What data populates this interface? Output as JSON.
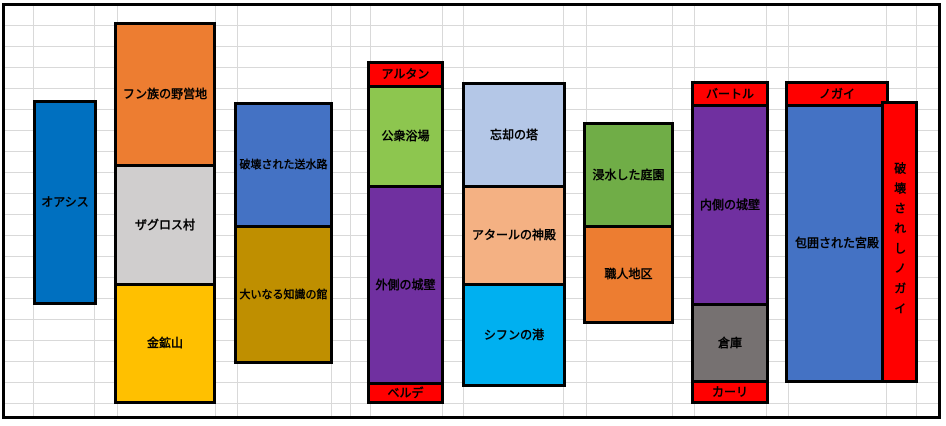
{
  "sheet": {
    "background": "#FFFFFF",
    "gridline_color": "#D9D9D9",
    "outer_border_color": "#000000",
    "label_text_color": "#000000",
    "enemy_header_color": "#FF0000"
  },
  "columns": [
    {
      "name": "oasis",
      "x": 36,
      "y": 103,
      "w": 58,
      "segments": [
        {
          "name": "oasis",
          "label": "オアシス",
          "color": "#0070C0",
          "h": 199
        }
      ]
    },
    {
      "name": "hun-zagros-goldmine",
      "x": 117,
      "y": 25,
      "w": 96,
      "segments": [
        {
          "name": "hun-camp",
          "label": "フン族の野営地",
          "color": "#ED7D31",
          "h": 139
        },
        {
          "name": "zagros-village",
          "label": "ザグロス村",
          "color": "#D0CECE",
          "h": 119
        },
        {
          "name": "gold-mine",
          "label": "金鉱山",
          "color": "#FFC000",
          "h": 118
        }
      ]
    },
    {
      "name": "aqueduct-knowledge",
      "x": 237,
      "y": 105,
      "w": 93,
      "segments": [
        {
          "name": "destroyed-aqueduct",
          "label": "破壊された送水路",
          "color": "#4472C4",
          "h": 120
        },
        {
          "name": "house-of-great-knowledge",
          "label": "大いなる知識の館",
          "color": "#BF8F00",
          "h": 136
        }
      ]
    },
    {
      "name": "altan-stack",
      "x": 370,
      "y": 64,
      "w": 71,
      "segments": [
        {
          "name": "altan",
          "label": "アルタン",
          "color": "#FF0000",
          "h": 21
        },
        {
          "name": "public-baths",
          "label": "公衆浴場",
          "color": "#8DC64F",
          "h": 100
        },
        {
          "name": "outer-wall",
          "label": "外側の城壁",
          "color": "#7030A0",
          "h": 197
        },
        {
          "name": "berde",
          "label": "ベルデ",
          "color": "#FF0000",
          "h": 19
        }
      ]
    },
    {
      "name": "tower-temple-port",
      "x": 465,
      "y": 85,
      "w": 98,
      "segments": [
        {
          "name": "tower-of-oblivion",
          "label": "忘却の塔",
          "color": "#B4C7E7",
          "h": 100
        },
        {
          "name": "temple-of-atar",
          "label": "アタールの神殿",
          "color": "#F4B183",
          "h": 98
        },
        {
          "name": "port-of-sifun",
          "label": "シフンの港",
          "color": "#00B0F0",
          "h": 101
        }
      ]
    },
    {
      "name": "garden-artisan",
      "x": 586,
      "y": 125,
      "w": 85,
      "segments": [
        {
          "name": "flooded-gardens",
          "label": "浸水した庭園",
          "color": "#70AD47",
          "h": 100
        },
        {
          "name": "artisan-district",
          "label": "職人地区",
          "color": "#ED7D31",
          "h": 96
        }
      ]
    },
    {
      "name": "bartol-stack",
      "x": 694,
      "y": 84,
      "w": 72,
      "segments": [
        {
          "name": "bartol",
          "label": "バートル",
          "color": "#FF0000",
          "h": 20
        },
        {
          "name": "inner-wall",
          "label": "内側の城壁",
          "color": "#7030A0",
          "h": 199
        },
        {
          "name": "warehouse",
          "label": "倉庫",
          "color": "#767171",
          "h": 77
        },
        {
          "name": "kari",
          "label": "カーリ",
          "color": "#FF0000",
          "h": 21
        }
      ]
    },
    {
      "name": "nogai-stack",
      "x": 788,
      "y": 84,
      "w": 98,
      "segments": [
        {
          "name": "nogai",
          "label": "ノガイ",
          "color": "#FF0000",
          "h": 20
        },
        {
          "name": "besieged-palace",
          "label": "包囲された宮殿",
          "color": "#4472C4",
          "h": 276
        }
      ]
    },
    {
      "name": "destroyed-nogai-strip",
      "x": 884,
      "y": 104,
      "w": 31,
      "segments": [
        {
          "name": "destroyed-nogai",
          "label": "破壊されしノガイ",
          "color": "#FF0000",
          "h": 276,
          "vertical": true
        }
      ]
    }
  ]
}
